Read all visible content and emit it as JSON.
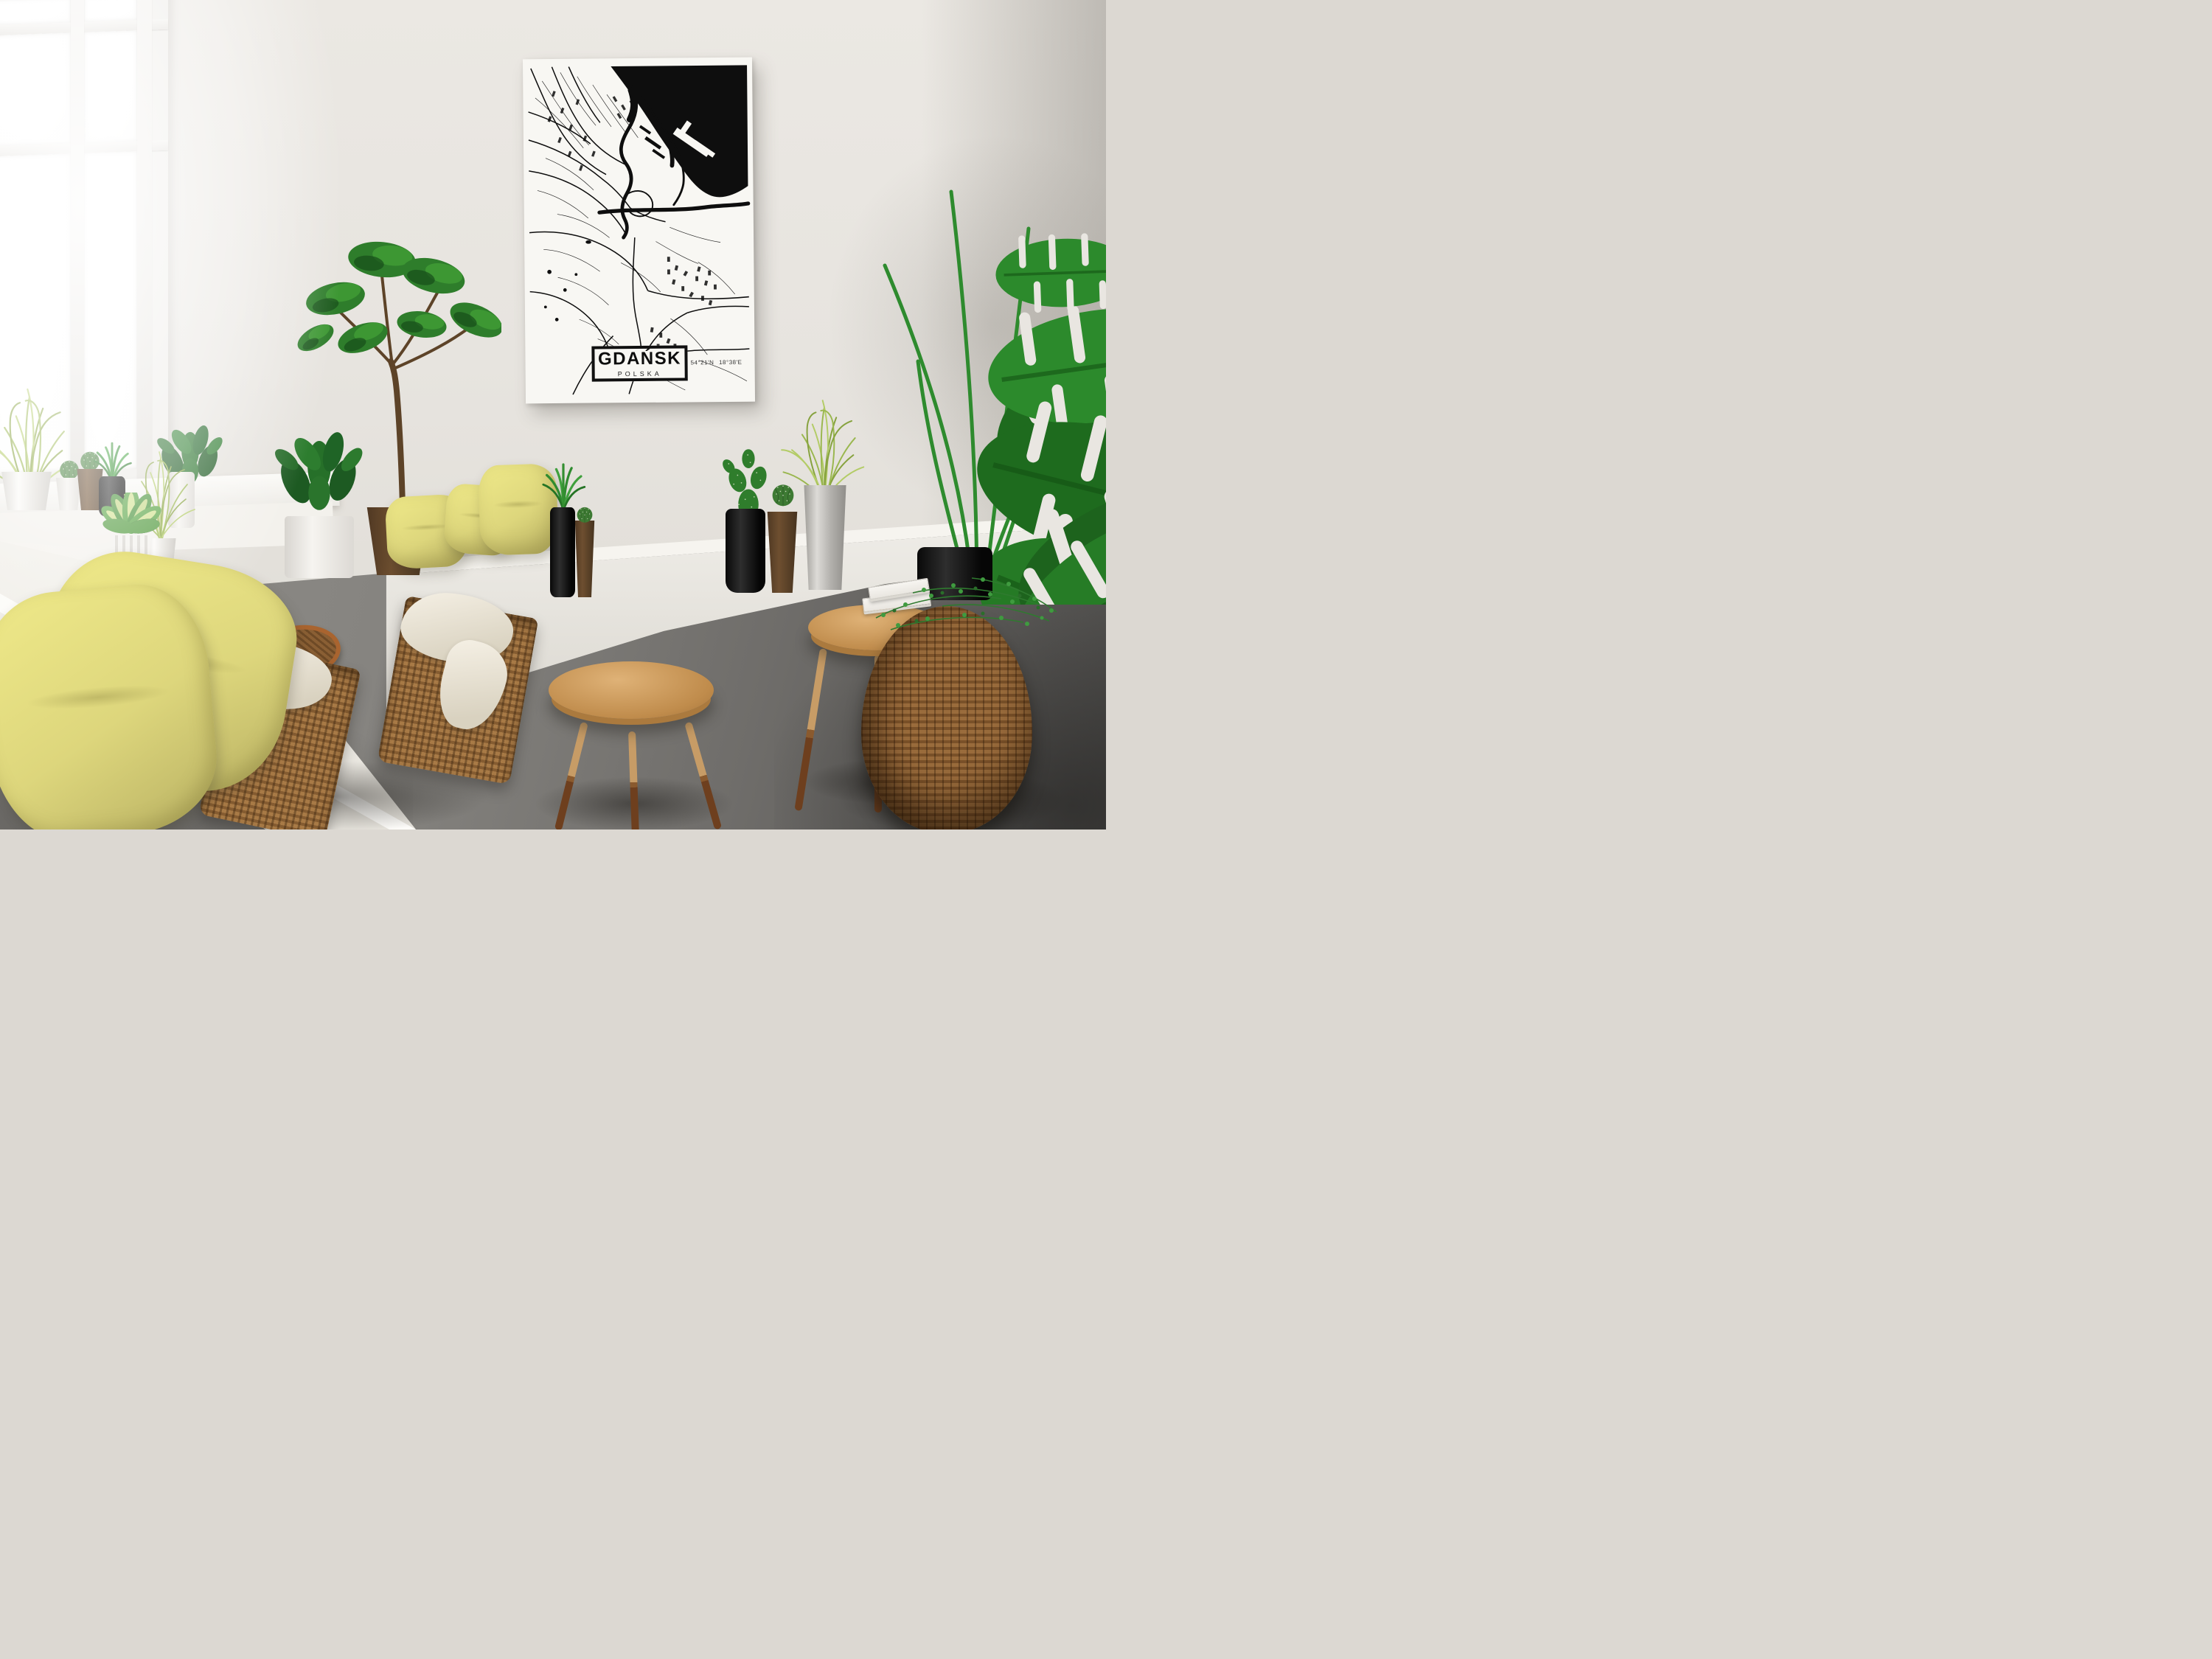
{
  "poster": {
    "title": "GDAŃSK",
    "subtitle": "POLSKA",
    "coordinates": "54°21'N 18°38'E"
  },
  "palette": {
    "wall": "#e9e6e1",
    "wall_shadow": "#cfcac3",
    "floor": "#87857f",
    "floor_dark": "#4c4b48",
    "window_frame": "#eceae6",
    "window_pane": "#fefefe",
    "bench_white": "#f4f2ed",
    "poster_bg": "#f8f7f3",
    "map_ink": "#0e0e0e",
    "pillow_yellow": "#ddd67c",
    "pillow_yellow_light": "#ece687",
    "pillow_shadow": "#b9b163",
    "cloth_cream": "#efe9dc",
    "leaf_green": "#2e8b2e",
    "leaf_dark": "#1d5c20",
    "leaf_light": "#3fa035",
    "grass_green": "#9ab74f",
    "wood_light": "#c9975a",
    "wood_dark": "#74421f",
    "wicker": "#9c6f3f",
    "wicker_dark": "#6e4a26",
    "pot_black": "#141414",
    "pot_brown": "#5b4228",
    "pot_white": "#edebe7",
    "pot_gray": "#b9b7b3"
  }
}
